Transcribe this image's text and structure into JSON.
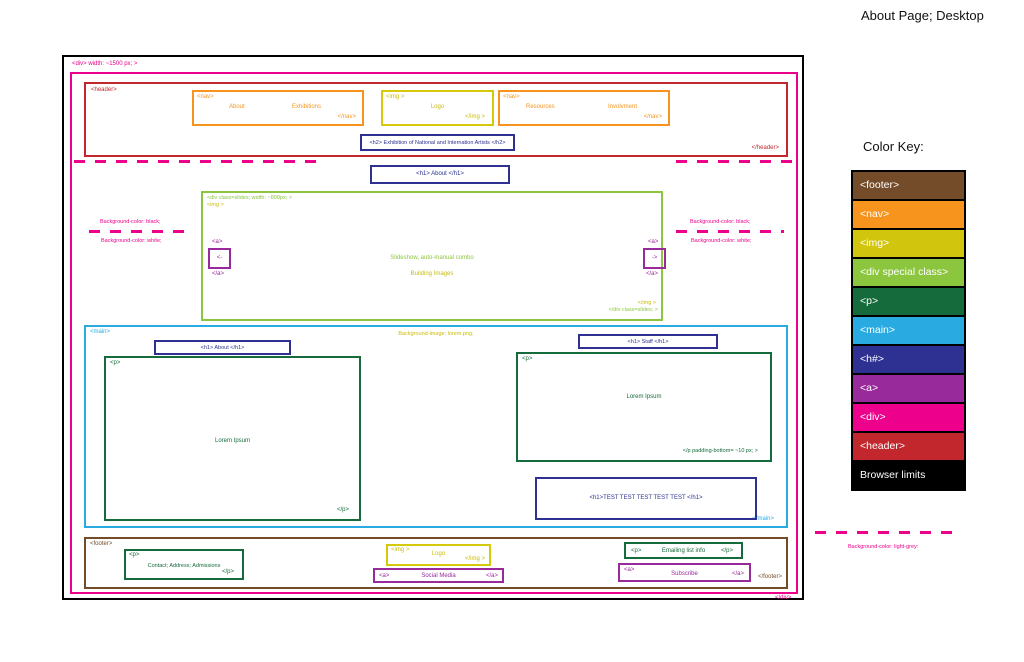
{
  "title": "About Page; Desktop",
  "annotations": {
    "div_open": "<div> width: ~1500 px; >",
    "div_close": "</div>",
    "bg_black_left": "Background-color: black;",
    "bg_white_left": "Background-color: white;",
    "bg_black_right": "Background-color: black;",
    "bg_white_right": "Background-color: white;",
    "bg_light_grey": "Background-color: light-grey:"
  },
  "header": {
    "open": "<header>",
    "close": "</header>",
    "nav_left": {
      "open": "<nav>",
      "close": "</nav>",
      "links": [
        "About",
        "Exhibitions"
      ]
    },
    "logo": {
      "open": "<img >",
      "label": "Logo",
      "close": "</img >"
    },
    "nav_right": {
      "open": "<nav>",
      "close": "</nav>",
      "links": [
        "Resources",
        "Involvment"
      ]
    },
    "h2": "<h2> Exhibition of National and Internation Artists </h2>"
  },
  "hero": {
    "h1": "<h1> About </h1>",
    "slideshow": {
      "open": "<div class=slides; width: ~800px; >",
      "img_open": "<img >",
      "img_close": "</img >",
      "close": "</div class=slides; >",
      "prev": {
        "open": "<a>",
        "arrow": "<-",
        "close": "</a>"
      },
      "next": {
        "open": "<a>",
        "arrow": "->",
        "close": "</a>"
      },
      "note_green": "Slideshow, auto-manual combo",
      "note_yellow": "Building Images"
    }
  },
  "main": {
    "open": "<main>",
    "close": "</main>",
    "bg_note": "Background-image: lorem.png;",
    "h1_about": "<h1> About </h1>",
    "h1_staff": "<h1> Staff </h1>",
    "p_about": {
      "open": "<p>",
      "body": "Lorem Ipsum",
      "close": "</p>"
    },
    "p_staff": {
      "open": "<p>",
      "body": "Lorem Ipsum",
      "close": "</p padding-bottom= ~10 px; >"
    },
    "h1_test": "<h1>TEST TEST TEST TEST TEST </h1>"
  },
  "footer": {
    "open": "<footer>",
    "close": "</footer>",
    "p_contact": {
      "open": "<p>",
      "body": "Contact; Address; Admissions",
      "close": "</p>"
    },
    "logo": {
      "open": "<img >",
      "label": "Logo",
      "close": "</img >"
    },
    "a_social": {
      "open": "<a>",
      "label": "Social Media",
      "close": "</a>"
    },
    "p_email": {
      "open": "<p>",
      "body": "Emailing list info",
      "close": "</p>"
    },
    "a_subscribe": {
      "open": "<a>",
      "label": "Subscribe",
      "close": "</a>"
    }
  },
  "color_key": {
    "title": "Color Key:",
    "items": [
      {
        "label": "<footer>",
        "color": "#754C29"
      },
      {
        "label": "<nav>",
        "color": "#F7941E"
      },
      {
        "label": "<img>",
        "color": "#D2C50E"
      },
      {
        "label": "<div special class>",
        "color": "#8CC63F"
      },
      {
        "label": "<p>",
        "color": "#156B3B"
      },
      {
        "label": "<main>",
        "color": "#29ABE2"
      },
      {
        "label": "<h#>",
        "color": "#2E3192"
      },
      {
        "label": "<a>",
        "color": "#982A9C"
      },
      {
        "label": "<div>",
        "color": "#EC008C"
      },
      {
        "label": "<header>",
        "color": "#C1272D"
      },
      {
        "label": "Browser limits",
        "color": "#000000"
      }
    ]
  }
}
